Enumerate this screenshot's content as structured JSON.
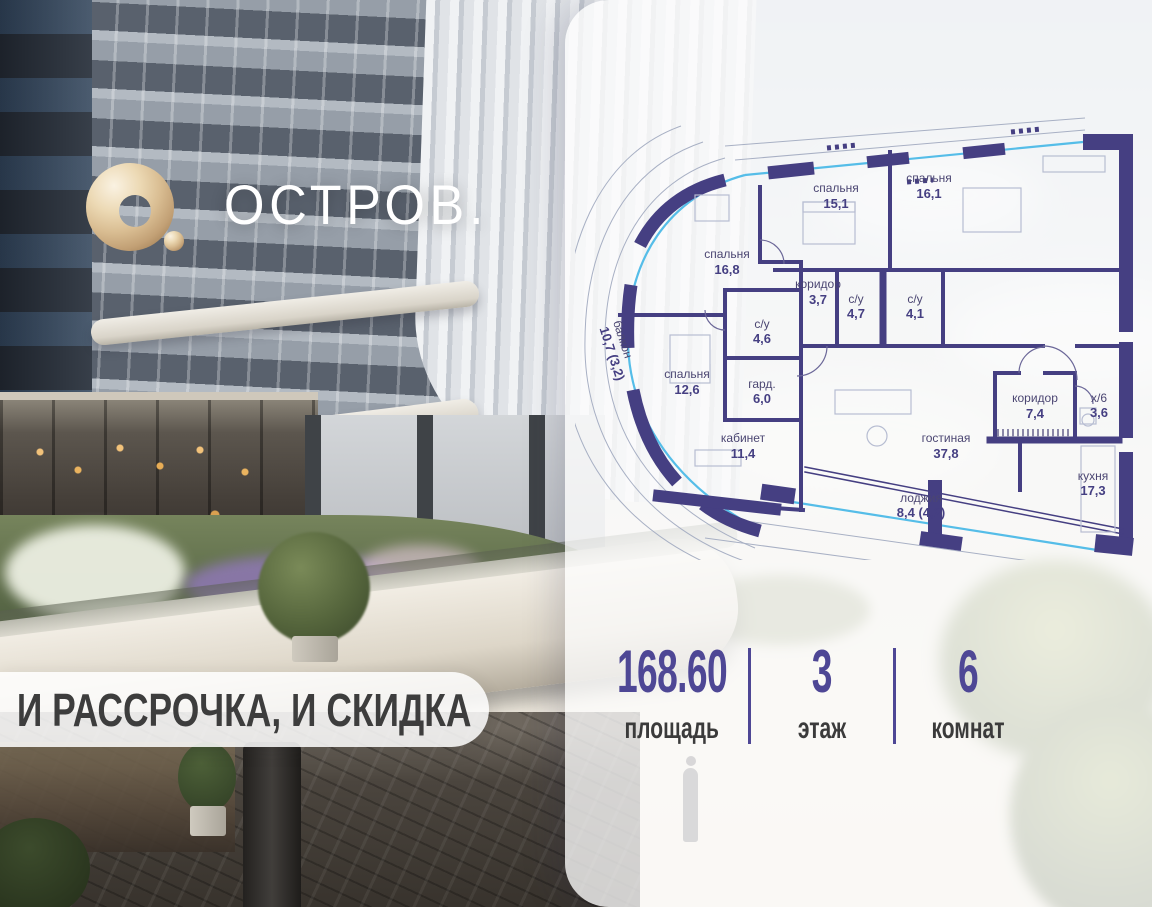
{
  "logo": {
    "brand": "ОСТРОВ.",
    "mark": "gold-ring-with-dot"
  },
  "promo_banner": {
    "text": "И РАССРОЧКА, И СКИДКА"
  },
  "floor_plan": {
    "rooms": [
      {
        "name": "спальня",
        "area": "15,1"
      },
      {
        "name": "спальня",
        "area": "16,1"
      },
      {
        "name": "спальня",
        "area": "16,8"
      },
      {
        "name": "коридор",
        "area": "3,7"
      },
      {
        "name": "с/у",
        "area": "4,7"
      },
      {
        "name": "с/у",
        "area": "4,1"
      },
      {
        "name": "с/у",
        "area": "4,6"
      },
      {
        "name": "спальня",
        "area": "12,6"
      },
      {
        "name": "гард.",
        "area": "6,0"
      },
      {
        "name": "кабинет",
        "area": "11,4"
      },
      {
        "name": "гостиная",
        "area": "37,8"
      },
      {
        "name": "коридор",
        "area": "7,4"
      },
      {
        "name": "х/6",
        "area": "3,6"
      },
      {
        "name": "кухня",
        "area": "17,3"
      },
      {
        "name": "лоджия",
        "area": "8,4 (4,2)"
      },
      {
        "name": "балкон",
        "area": "10,7 (3,2)"
      }
    ],
    "colors": {
      "wall": "#453f82",
      "glass": "#55bde8",
      "label": "#4b4672"
    }
  },
  "stats": [
    {
      "value": "168.60",
      "label": "площадь"
    },
    {
      "value": "3",
      "label": "этаж"
    },
    {
      "value": "6",
      "label": "комнат"
    }
  ],
  "colors": {
    "accent_purple": "#4e4795",
    "logo_gold": "#d9bd92",
    "banner_text": "#3d3d3d"
  }
}
